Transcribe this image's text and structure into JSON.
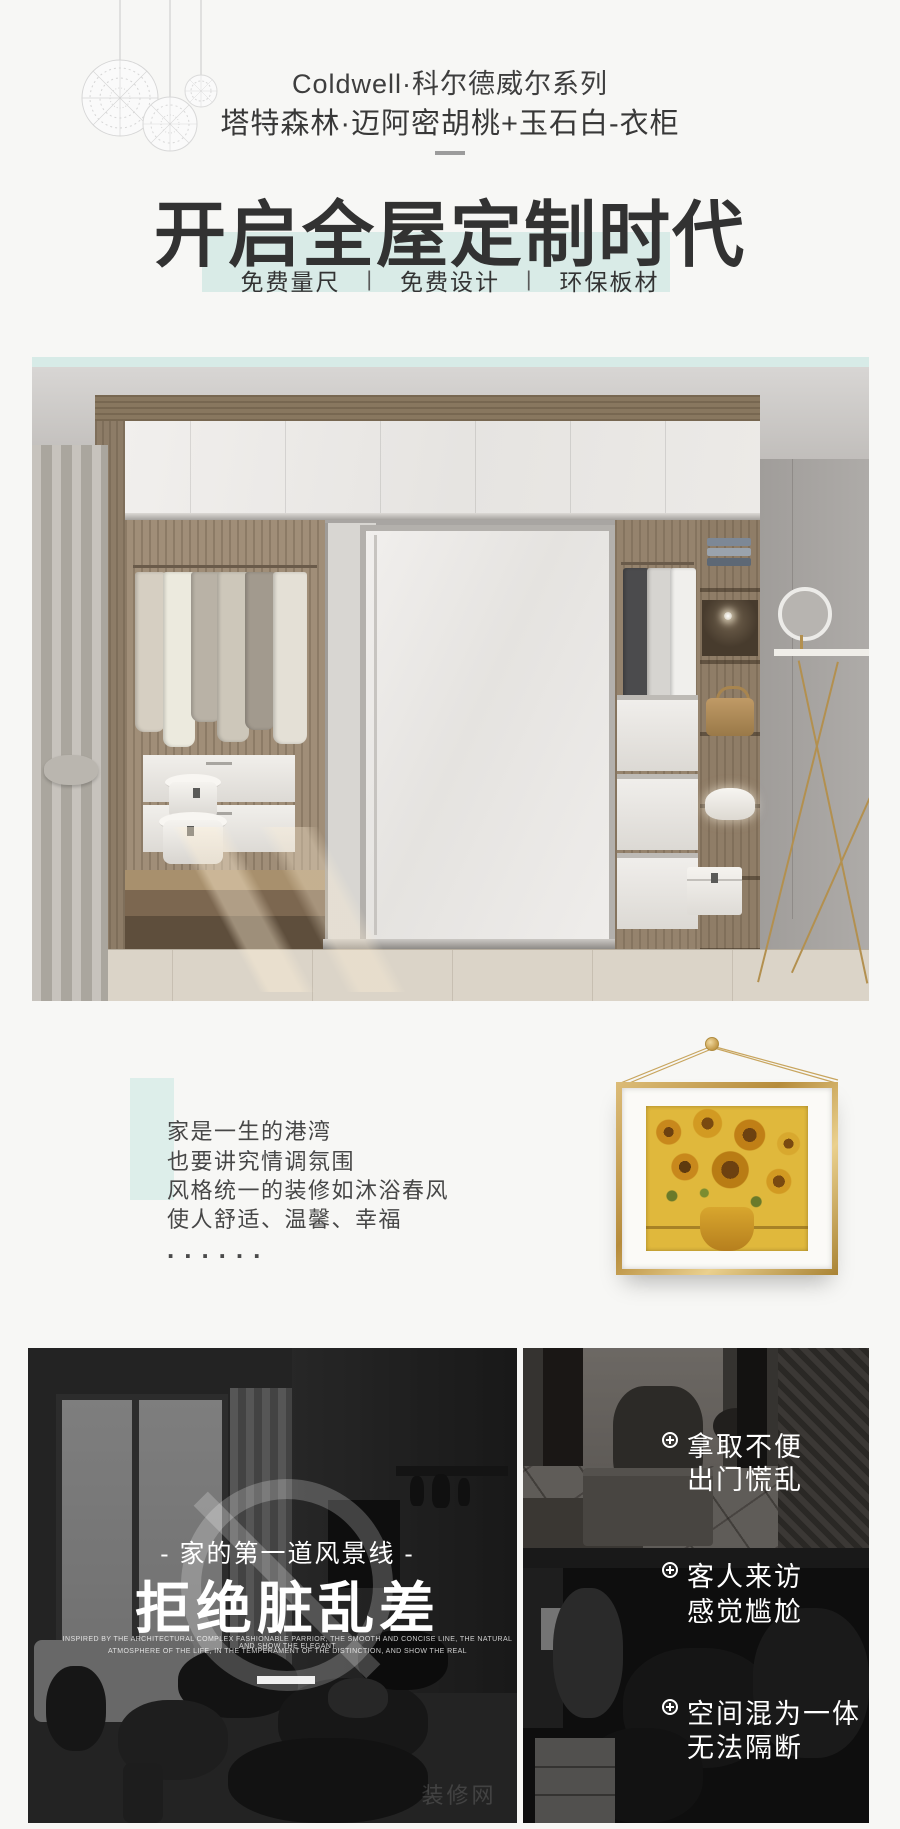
{
  "colors": {
    "accent_teal": "#d9ebe7",
    "title_dark": "#323232",
    "frame_gold": "#c9a25a",
    "page_bg": "#f7f7f5"
  },
  "header": {
    "brand_line": "Coldwell·科尔德威尔系列",
    "product_line": "塔特森林·迈阿密胡桃+玉石白-衣柜",
    "main_title": "开启全屋定制时代",
    "separator": "|",
    "features": [
      {
        "label": "免费量尺"
      },
      {
        "label": "免费设计"
      },
      {
        "label": "环保板材"
      }
    ]
  },
  "intro": {
    "lines": [
      "家是一生的港湾",
      "也要讲究情调氛围",
      "风格统一的装修如沐浴春风",
      "使人舒适、温馨、幸福"
    ],
    "ellipsis": "......"
  },
  "pain": {
    "tagline": "- 家的第一道风景线 -",
    "headline": "拒绝脏乱差",
    "caption1": "INSPIRED BY THE ARCHITECTURAL COMPLEX FASHIONABLE PARRIOR, THE SMOOTH AND CONCISE LINE, THE NATURAL AND SHOW THE ELEGANT",
    "caption2": "ATMOSPHERE OF THE LIFE, IN THE TEMPERAMENT OF THE DISTINCTION, AND SHOW THE REAL",
    "watermark": "装修网",
    "bullets": [
      {
        "line1": "拿取不便",
        "line2": "出门慌乱"
      },
      {
        "line1": "客人来访",
        "line2": "感觉尴尬"
      },
      {
        "line1": "空间混为一体",
        "line2": "无法隔断"
      }
    ]
  }
}
